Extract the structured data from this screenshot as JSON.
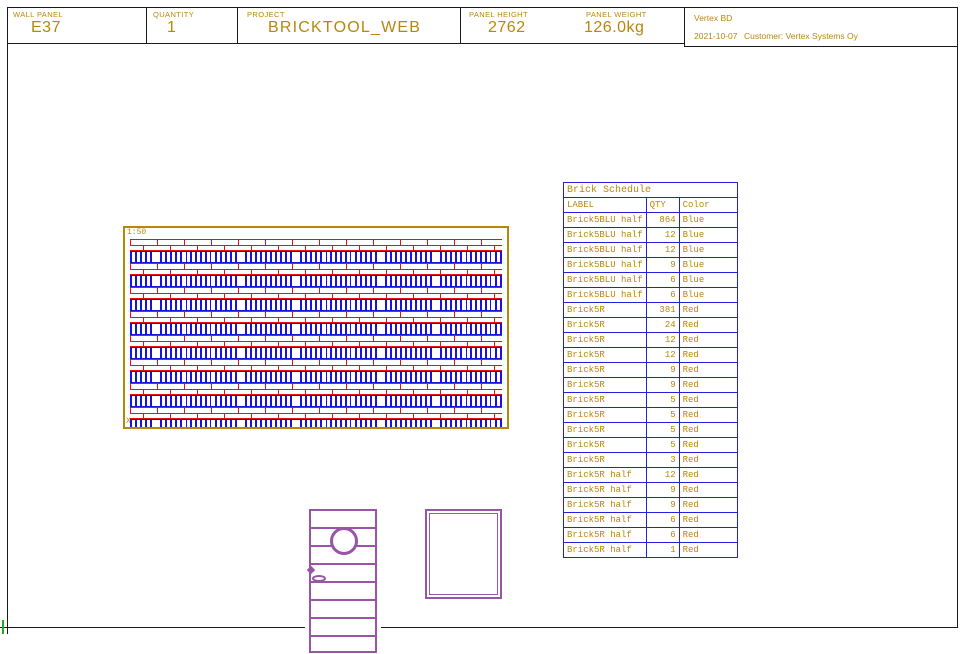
{
  "header": {
    "wall_panel_label": "WALL PANEL",
    "wall_panel_value": "E37",
    "quantity_label": "QUANTITY",
    "quantity_value": "1",
    "project_label": "PROJECT",
    "project_value": "BRICKTOOL_WEB",
    "panel_height_label": "PANEL HEIGHT",
    "panel_height_value": "2762",
    "panel_weight_label": "PANEL WEIGHT",
    "panel_weight_value": "126.0kg"
  },
  "title_box": {
    "app_name": "Vertex BD",
    "date": "2021-10-07",
    "customer": "Customer: Vertex Systems Oy"
  },
  "drawing": {
    "scale_label": "1:50",
    "axis_label": "XY"
  },
  "schedule": {
    "title": "Brick Schedule",
    "columns": [
      "LABEL",
      "QTY",
      "Color"
    ],
    "rows": [
      {
        "label": "Brick5BLU half",
        "qty": "864",
        "color": "Blue"
      },
      {
        "label": "Brick5BLU half",
        "qty": "12",
        "color": "Blue"
      },
      {
        "label": "Brick5BLU half",
        "qty": "12",
        "color": "Blue"
      },
      {
        "label": "Brick5BLU half",
        "qty": "9",
        "color": "Blue"
      },
      {
        "label": "Brick5BLU half",
        "qty": "6",
        "color": "Blue"
      },
      {
        "label": "Brick5BLU half",
        "qty": "6",
        "color": "Blue"
      },
      {
        "label": "Brick5R",
        "qty": "381",
        "color": "Red"
      },
      {
        "label": "Brick5R",
        "qty": "24",
        "color": "Red"
      },
      {
        "label": "Brick5R",
        "qty": "12",
        "color": "Red"
      },
      {
        "label": "Brick5R",
        "qty": "12",
        "color": "Red"
      },
      {
        "label": "Brick5R",
        "qty": "9",
        "color": "Red"
      },
      {
        "label": "Brick5R",
        "qty": "9",
        "color": "Red"
      },
      {
        "label": "Brick5R",
        "qty": "5",
        "color": "Red"
      },
      {
        "label": "Brick5R",
        "qty": "5",
        "color": "Red"
      },
      {
        "label": "Brick5R",
        "qty": "5",
        "color": "Red"
      },
      {
        "label": "Brick5R",
        "qty": "5",
        "color": "Red"
      },
      {
        "label": "Brick5R",
        "qty": "3",
        "color": "Red"
      },
      {
        "label": "Brick5R half",
        "qty": "12",
        "color": "Red"
      },
      {
        "label": "Brick5R half",
        "qty": "9",
        "color": "Red"
      },
      {
        "label": "Brick5R half",
        "qty": "9",
        "color": "Red"
      },
      {
        "label": "Brick5R half",
        "qty": "6",
        "color": "Red"
      },
      {
        "label": "Brick5R half",
        "qty": "6",
        "color": "Red"
      },
      {
        "label": "Brick5R half",
        "qty": "1",
        "color": "Red"
      }
    ]
  },
  "colors": {
    "gold": "#B8860B",
    "brick_red": "#E81010",
    "brick_blue": "#1414DD",
    "table_blue": "#2222DD",
    "opening_purple": "#9955A5",
    "marker_green": "#22AA22"
  }
}
